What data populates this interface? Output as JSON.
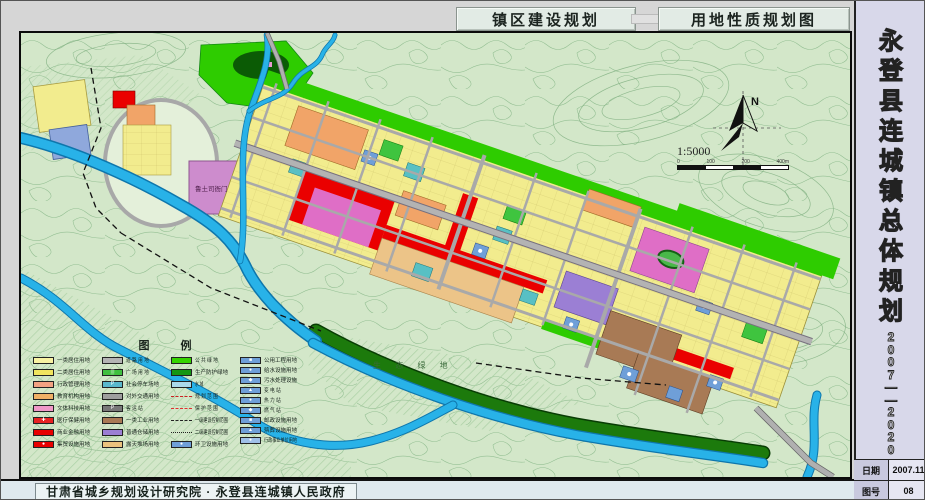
{
  "header": {
    "title_left": "镇区建设规划",
    "title_right": "用地性质规划图"
  },
  "sidebar": {
    "title_vertical": "永登县连城镇总体规划",
    "years_vertical": "2007——2020",
    "date_label": "日期",
    "date_value": "2007.11",
    "sheet_label": "图号",
    "sheet_value": "08"
  },
  "footer": {
    "credit": "甘肃省城乡规划设计研究院 · 永登县连城镇人民政府"
  },
  "map": {
    "north_label": "N",
    "scale_text": "1:5000",
    "scale_ticks": [
      "0",
      "100",
      "200",
      "400m"
    ],
    "labels": {
      "eco_green": "生 态 绿 地",
      "heritage": "鲁土司衙门"
    },
    "colors": {
      "background": "#d3e7c9",
      "contour": "#8dbb8d",
      "river": "#28b2e8",
      "road": "#a9a9a9",
      "residential_1": "#f8f2a2",
      "residential_2": "#f2ec8e",
      "commercial_red": "#ea0000",
      "culture_pink": "#df6ec6",
      "education_orange": "#f1a468",
      "industry_brown": "#a87a55",
      "storage_purple": "#9b7fd4",
      "storage_tan": "#ecc488",
      "utility_blue": "#6f9fd8",
      "parking_teal": "#58c0c4",
      "green_public": "#2ecc00",
      "green_dark": "#0b5b05"
    }
  },
  "legend": {
    "title": "图    例",
    "columns": [
      [
        {
          "label": "一类居住用地",
          "color": "#f8f2a2"
        },
        {
          "label": "二类居住用地",
          "color": "#f0e45e"
        },
        {
          "label": "行政管理用地",
          "color": "#f2a182"
        },
        {
          "label": "教育机构用地",
          "color": "#f0b066"
        },
        {
          "label": "文体科技用地",
          "color": "#f098c8"
        },
        {
          "label": "医疗保健用地",
          "color": "#e82222",
          "sym": "✚"
        },
        {
          "label": "商业金融用地",
          "color": "#e80000"
        },
        {
          "label": "集贸设施用地",
          "color": "#e80000",
          "sym": "●"
        }
      ],
      [
        {
          "label": "道 路 用 地",
          "color": "#b4b4b4"
        },
        {
          "label": "广 场 用 地",
          "color": "#3fbf3f",
          "sym": "▒"
        },
        {
          "label": "社会停车场地",
          "color": "#5ab8cc",
          "sym": "P"
        },
        {
          "label": "对外交通用地",
          "color": "#9e9e9e"
        },
        {
          "label": "客  运  站",
          "color": "#787878",
          "sym": "P"
        },
        {
          "label": "一类工业用地",
          "color": "#a97a55"
        },
        {
          "label": "普通仓储用地",
          "color": "#9b7fd4"
        },
        {
          "label": "露天堆场用地",
          "color": "#eac27e"
        }
      ],
      [
        {
          "label": "公 共 绿 地",
          "color": "#35d400"
        },
        {
          "label": "生产防护绿地",
          "color": "#149614"
        },
        {
          "label": "水       域",
          "color": "#aad8ea"
        },
        {
          "label": "规 划 范 围",
          "line": "dashed",
          "lineColor": "#cc2222"
        },
        {
          "label": "保 护 范 围",
          "line": "dashed",
          "lineColor": "#e03030"
        },
        {
          "label": "一级建设控制范围",
          "line": "dashed",
          "lineColor": "#222222"
        },
        {
          "label": "二级建设控制范围",
          "line": "dotted",
          "lineColor": "#222222"
        },
        {
          "label": "环卫设施用地",
          "color": "#6f9fd8",
          "sym": "●"
        }
      ],
      [
        {
          "label": "公用工程用地",
          "color": "#6f9fd8",
          "sym": "■"
        },
        {
          "label": "给水设施用地",
          "color": "#6f9fd8",
          "sym": "●"
        },
        {
          "label": "污水处理设施",
          "color": "#6f9fd8",
          "sym": "◆"
        },
        {
          "label": "变  电  站",
          "color": "#6f9fd8",
          "sym": "▲"
        },
        {
          "label": "热  力  站",
          "color": "#6f9fd8",
          "sym": "●"
        },
        {
          "label": "燃  气  站",
          "color": "#6f9fd8",
          "sym": "◆"
        },
        {
          "label": "邮政设施用地",
          "color": "#6f9fd8",
          "sym": "■"
        },
        {
          "label": "殡葬设施用地",
          "color": "#6f9fd8",
          "sym": "▲"
        },
        {
          "label": "行政事业单位用地",
          "color": "#9fc0e8",
          "sym": "●"
        }
      ]
    ]
  }
}
